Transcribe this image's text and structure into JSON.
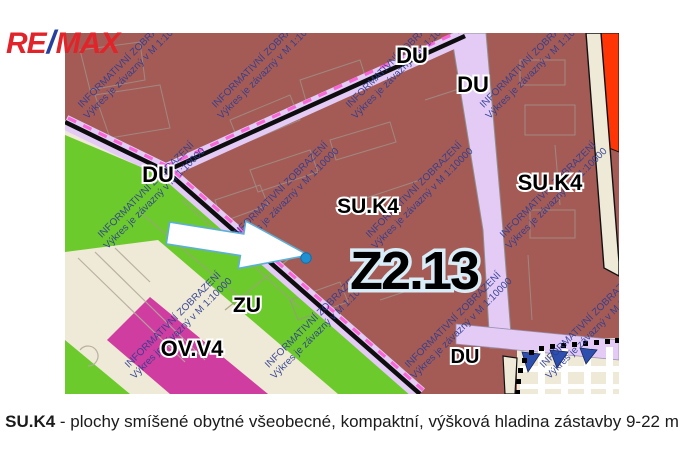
{
  "logo": {
    "re": "RE",
    "slash": "/",
    "max": "MAX"
  },
  "map": {
    "watermark": {
      "line1": "INFORMATIVNÍ ZOBRAZENÍ",
      "line2": "Výkres je závazný v M 1:10000"
    },
    "labels": {
      "du_top": "DU",
      "du_right_top": "DU",
      "du_left": "DU",
      "du_bottom": "DU",
      "suk4_center": "SU.K4",
      "suk4_right": "SU.K4",
      "zu": "ZU",
      "ovv4": "OV.V4",
      "big_code": "Z2.13"
    }
  },
  "caption": {
    "code": "SU.K4",
    "rest": " - plochy smíšené obytné všeobecné, kompaktní, výšková hladina zástavby 9-22 m"
  },
  "colors": {
    "maroon": "#a55b55",
    "green": "#6cca2c",
    "magenta": "#cf3da0",
    "lavender": "#e3cbf6",
    "cream": "#efe9d7",
    "orange": "#ff3506",
    "navy": "#2e3d92",
    "road_black": "#0e0e0e",
    "pink_dash": "#f966d7",
    "arrow_outline": "#5cb0d8",
    "dot_blue": "#1e90d2",
    "logo_red": "#e1242a",
    "logo_blue": "#27409e",
    "grid_white": "#ffffff",
    "triangle_blue": "#2d4fae"
  }
}
